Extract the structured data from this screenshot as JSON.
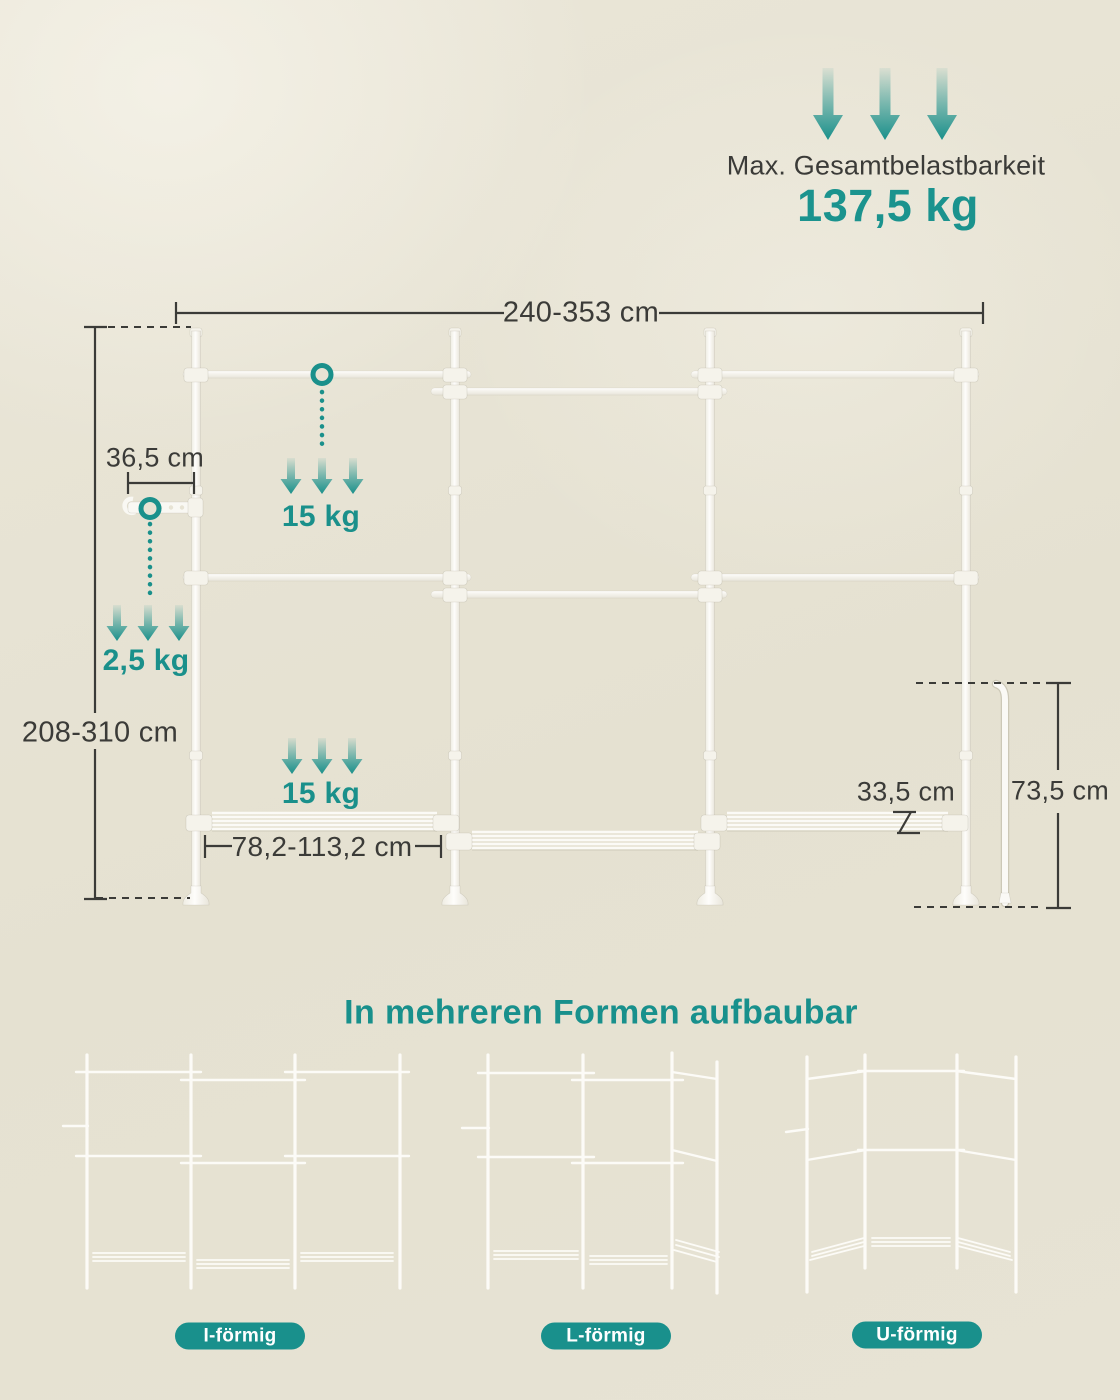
{
  "colors": {
    "teal": "#1a908b",
    "ink": "#3b3b38",
    "background": "#e6e2d3",
    "structure_white": "#fbfaf6"
  },
  "max_load": {
    "label": "Max. Gesamtbelastbarkeit",
    "value": "137,5 kg"
  },
  "diagram": {
    "width_range": "240-353 cm",
    "height_range": "208-310 cm",
    "hook_arm": "36,5 cm",
    "rail_load": "15 kg",
    "hook_load": "2,5 kg",
    "shelf_load": "15 kg",
    "shelf_width_range": "78,2-113,2 cm",
    "shelf_depth": "33,5 cm",
    "side_pole_height": "73,5 cm"
  },
  "variants_section": {
    "title": "In mehreren Formen aufbaubar",
    "variants": [
      {
        "label": "I-förmig"
      },
      {
        "label": "L-förmig"
      },
      {
        "label": "U-förmig"
      }
    ]
  }
}
